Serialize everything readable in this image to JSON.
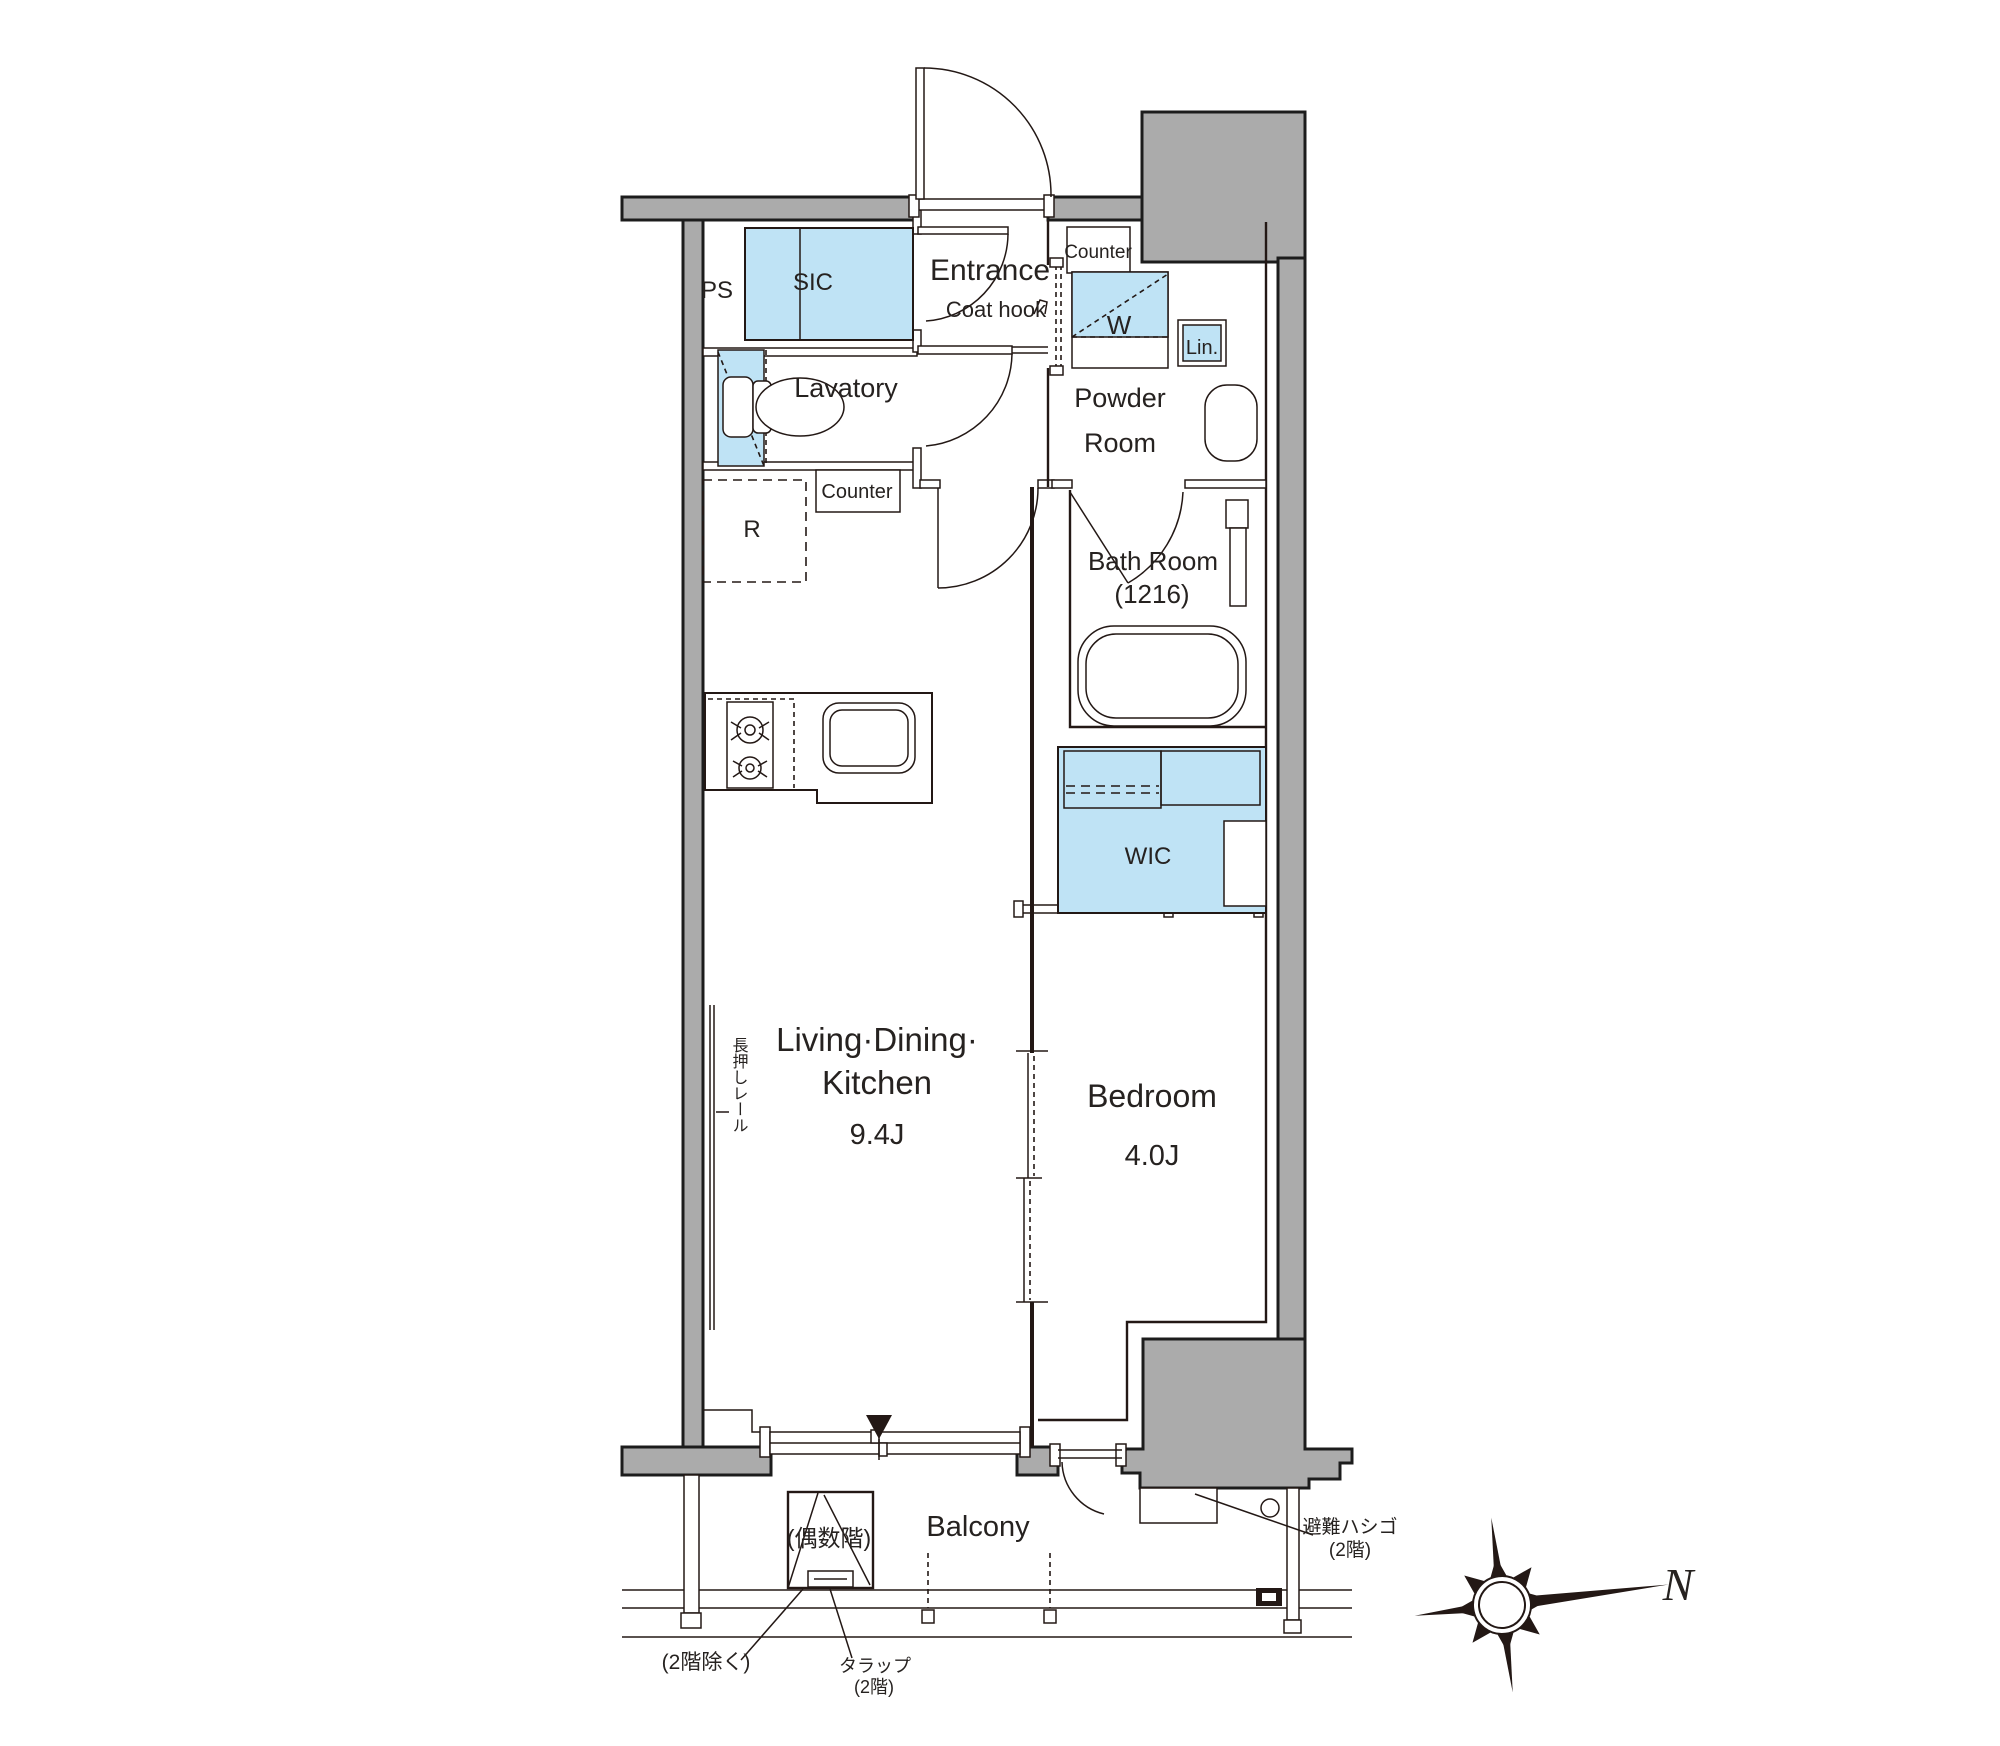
{
  "floorplan": {
    "rooms": {
      "ps": "PS",
      "sic": "SIC",
      "entrance": "Entrance",
      "lavatory": "Lavatory",
      "powder_line1": "Powder",
      "powder_line2": "Room",
      "bath_line1": "Bath Room",
      "bath_line2": "(1216)",
      "wic": "WIC",
      "ldk_line1": "Living·Dining·",
      "ldk_line2": "Kitchen",
      "ldk_size": "9.4J",
      "bedroom": "Bedroom",
      "bedroom_size": "4.0J",
      "balcony": "Balcony"
    },
    "fixtures": {
      "coat_hook": "Coat hook",
      "counter_powder": "Counter",
      "washer": "W",
      "linen": "Lin.",
      "counter_kitchen": "Counter",
      "refrigerator": "R"
    },
    "annotations": {
      "nageshi_rail": "長押しレール",
      "hatch_even_floor": "(偶数階)",
      "escape_ladder_line1": "避難ハシゴ",
      "escape_ladder_line2": "(2階)",
      "except_2f": "(2階除く)",
      "trap_line1": "タラップ",
      "trap_line2": "(2階)"
    },
    "compass": {
      "north": "N"
    },
    "colors": {
      "fixture_blue": "#bfe3f5",
      "wall_gray": "#ababab",
      "line_dark": "#231815"
    }
  }
}
